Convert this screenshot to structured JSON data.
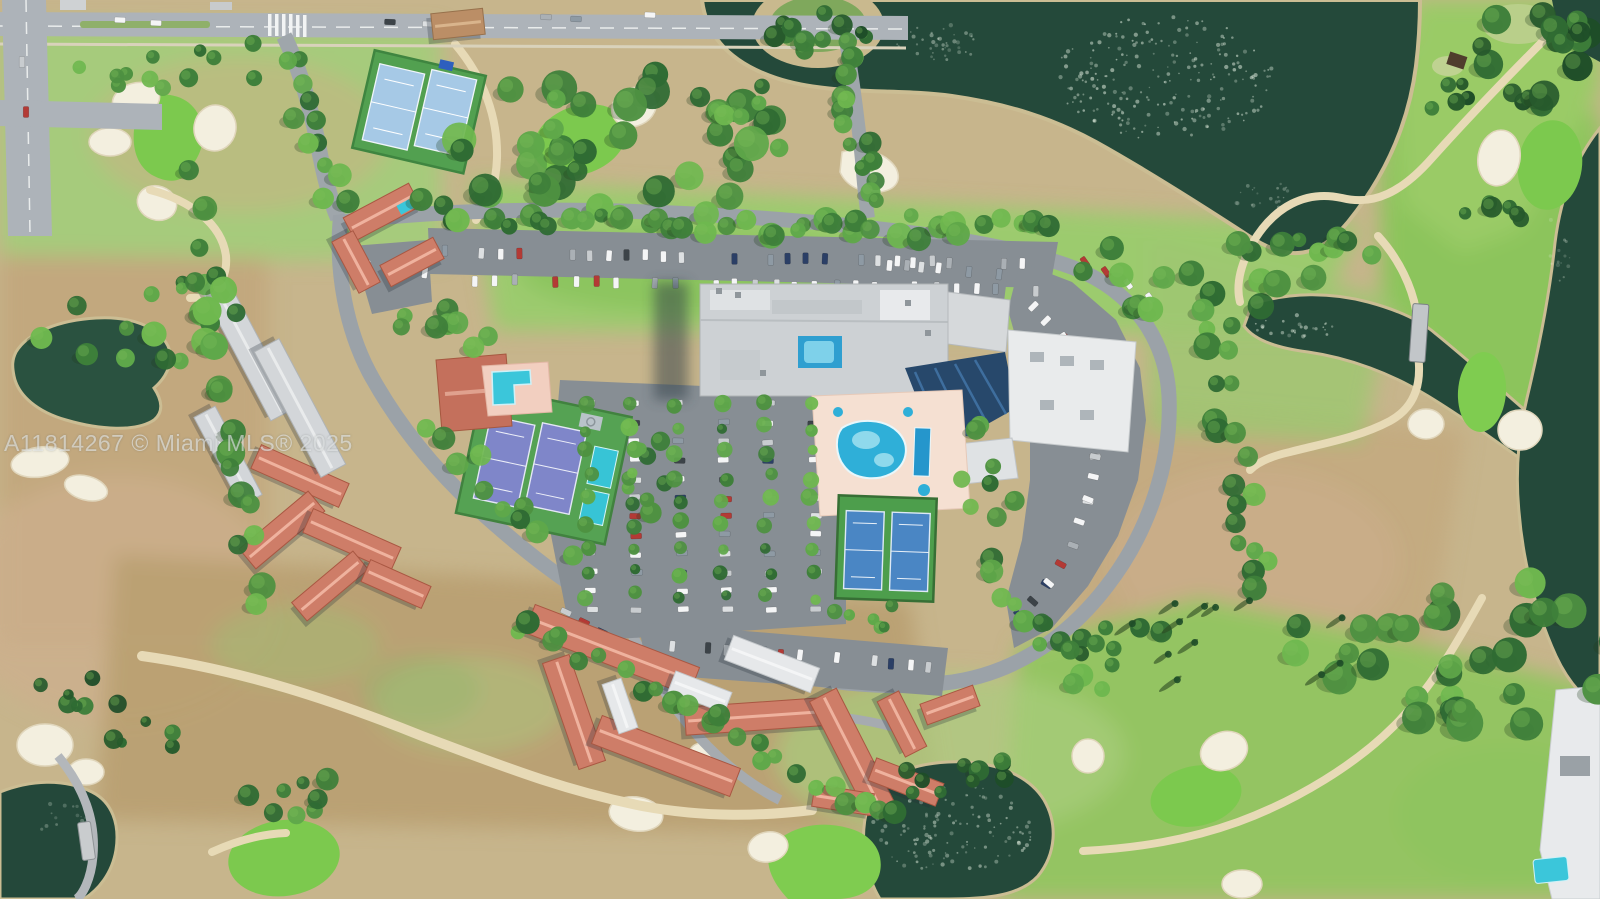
{
  "watermark": {
    "text": "A11814267 © Miami MLS® 2025"
  },
  "scene": {
    "type": "aerial-satellite-photo",
    "subject": "Top-down aerial view of a condominium community with clubhouse, pools and tennis courts on an island parcel surrounded by a golf course, lakes and canals",
    "features": [
      "golf-course-fairways",
      "putting-greens",
      "sand-bunkers",
      "cart-paths",
      "cart-bridge",
      "lake-with-island",
      "canal",
      "ponds",
      "tree-canopy",
      "palm-trees",
      "clubhouse-buildings",
      "condo-buildings-red-roofs",
      "gray-roof-buildings",
      "swimming-pool-lagoon",
      "lap-pool",
      "rooftop-courtyard-pool",
      "pool-deck",
      "tennis-courts",
      "pickleball-courts",
      "parking-lots",
      "cars",
      "city-street",
      "crosswalk"
    ],
    "palette": {
      "water_dark": "#24493A",
      "water_edge": "#CBBD93",
      "sparkle": "#E6F1E3",
      "fairway_green": "#9CCB6E",
      "bright_green": "#7CC94E",
      "dry_grass": "#C7B58C",
      "bunker_sand": "#F3EFDF",
      "path_sand": "#E7DAB6",
      "asphalt": "#878E94",
      "road": "#ADB3B9",
      "ring_road": "#9BA2A8",
      "gray_roof": "#D3D6D9",
      "white_roof": "#E6E8EA",
      "red_roof": "#CE7D68",
      "tan_roof": "#BB8E66",
      "pool_blue": "#35B6DC",
      "pool_light": "#8FD9EC",
      "tennis_green": "#4E9D4A",
      "court_blue": "#4A86C4",
      "court_purple": "#7F86C9",
      "court_lightblue": "#A6C9E6",
      "court_teal": "#37C4D6",
      "tree_dark": "#2F6B33",
      "tree_mid": "#4E9141",
      "tree_light": "#6FB84F"
    },
    "car_colors": [
      "#F4F5F6",
      "#F4F5F6",
      "#F4F5F6",
      "#DDE0E2",
      "#AAB0B5",
      "#3C4348",
      "#2B3F66",
      "#8E9AA4",
      "#B33A35",
      "#C8CCCF"
    ]
  }
}
